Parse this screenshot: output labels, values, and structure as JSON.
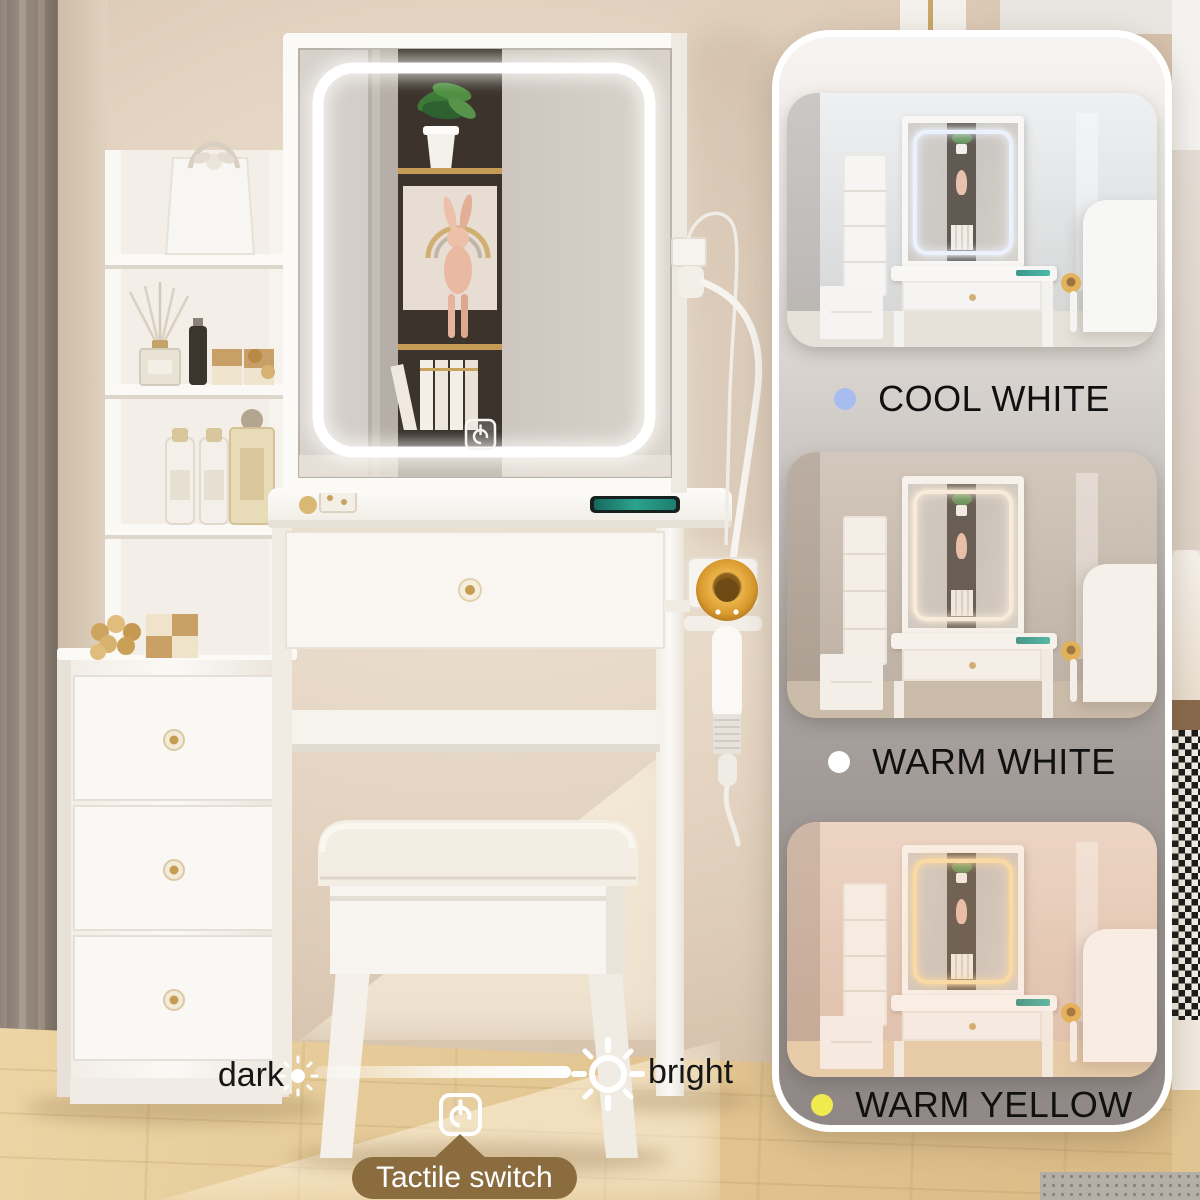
{
  "product_scene": {
    "annotations": {
      "dark_label": "dark",
      "bright_label": "bright",
      "tactile_switch_label": "Tactile switch"
    },
    "icons": {
      "dim_sun": "sun-icon",
      "bright_sun": "sun-icon",
      "tactile_power": "power-icon",
      "mirror_touch": "power-touch-icon"
    },
    "colors": {
      "tactile_pill_bg": "#8a6c3f",
      "brightness_bar": "#ffffff",
      "led_main": "#ffffff"
    }
  },
  "panel": {
    "border_color": "#ffffff",
    "modes": [
      {
        "label": "COOL WHITE",
        "dot_color": "#a7bdf0",
        "led_color": "#eef4ff"
      },
      {
        "label": "WARM WHITE",
        "dot_color": "#ffffff",
        "led_color": "#fff3e0"
      },
      {
        "label": "WARM YELLOW",
        "dot_color": "#efeb4e",
        "led_color": "#ffdf9f"
      }
    ]
  }
}
